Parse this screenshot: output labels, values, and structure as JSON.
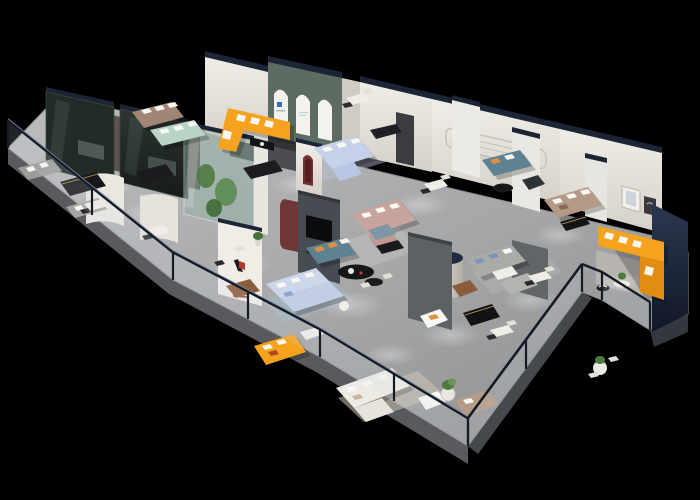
{
  "scene": {
    "type": "isometric-3d-floorplan-render",
    "subject": "furniture-showroom"
  },
  "palette": {
    "background": "#000000",
    "floor_light": "#bcbcbe",
    "floor_dark": "#8b8c8e",
    "floor_edge": "#55585c",
    "wall_light": "#f0ede7",
    "wall_shade": "#d5d1c9",
    "wall_cap_navy": "#1b2536",
    "end_wall_navy": "#1c2a3e",
    "arch_wall_teal": "#5c6c63",
    "arch_white": "#f4f2ec",
    "arch_logo_blue": "#2f6fc4",
    "niche_red": "#733231",
    "glass_box_dark": "#232b27",
    "terrarium_glass": "#8fb3a6",
    "plant_green": "#4e7a3e",
    "sofa_orange": "#f5a21f",
    "sofa_orange_shade": "#e28c12",
    "sofa_mint": "#b9d4c4",
    "sofa_taupe": "#a18673",
    "sofa_periwinkle": "#c5d0ea",
    "sofa_pink": "#c7a49c",
    "sofa_teal": "#5e8292",
    "sofa_tan": "#b49a86",
    "sofa_lightblue": "#ccd5ea",
    "sofa_white": "#edebe4",
    "sofa_gray": "#a9aba7",
    "sofa_leather": "#8a5c3c",
    "pillow_white": "#f8f7f4",
    "pillow_orange": "#e09140",
    "table_black": "#17171a",
    "credenza_black": "#18181b",
    "credenza_gold": "#c9a35a",
    "rug_blue": "#a3b6c2",
    "rug_beige": "#cdc3b2",
    "rug_marble": "#c8c2b8",
    "tv_wall_gray": "#474c52",
    "partition_gray": "#5c6164",
    "maroon_panel": "#6e3634",
    "logo_red": "#b33a2e",
    "logo_black": "#1c1c1e",
    "rail_frame": "#141b26",
    "rail_glass": "#d4dee4"
  }
}
